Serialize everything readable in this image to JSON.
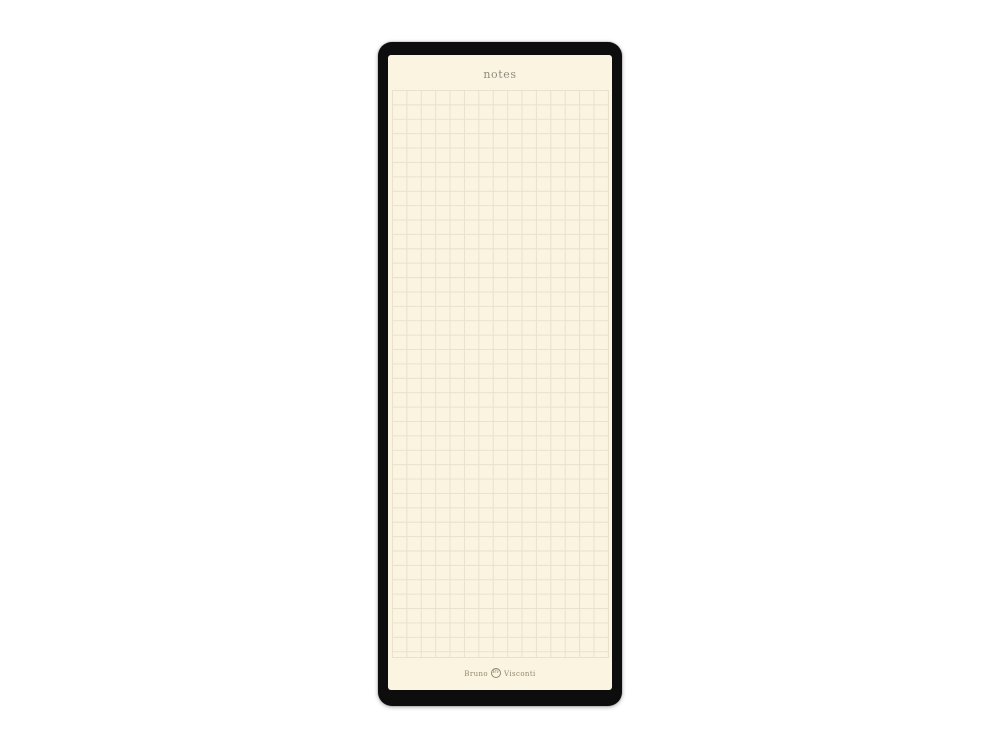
{
  "page": {
    "title": "notes"
  },
  "brand": {
    "first": "Bruno",
    "last": "Visconti",
    "monogram": "BV"
  },
  "paper": {
    "style": "square-grid",
    "grid_cell_px": 14.4
  },
  "colors": {
    "cover": "#0d0d0d",
    "paper": "#fbf4e1",
    "grid_line": "#e9e1cb",
    "title_text": "#8d8c82",
    "brand_text": "#94886f",
    "background": "#ffffff"
  }
}
